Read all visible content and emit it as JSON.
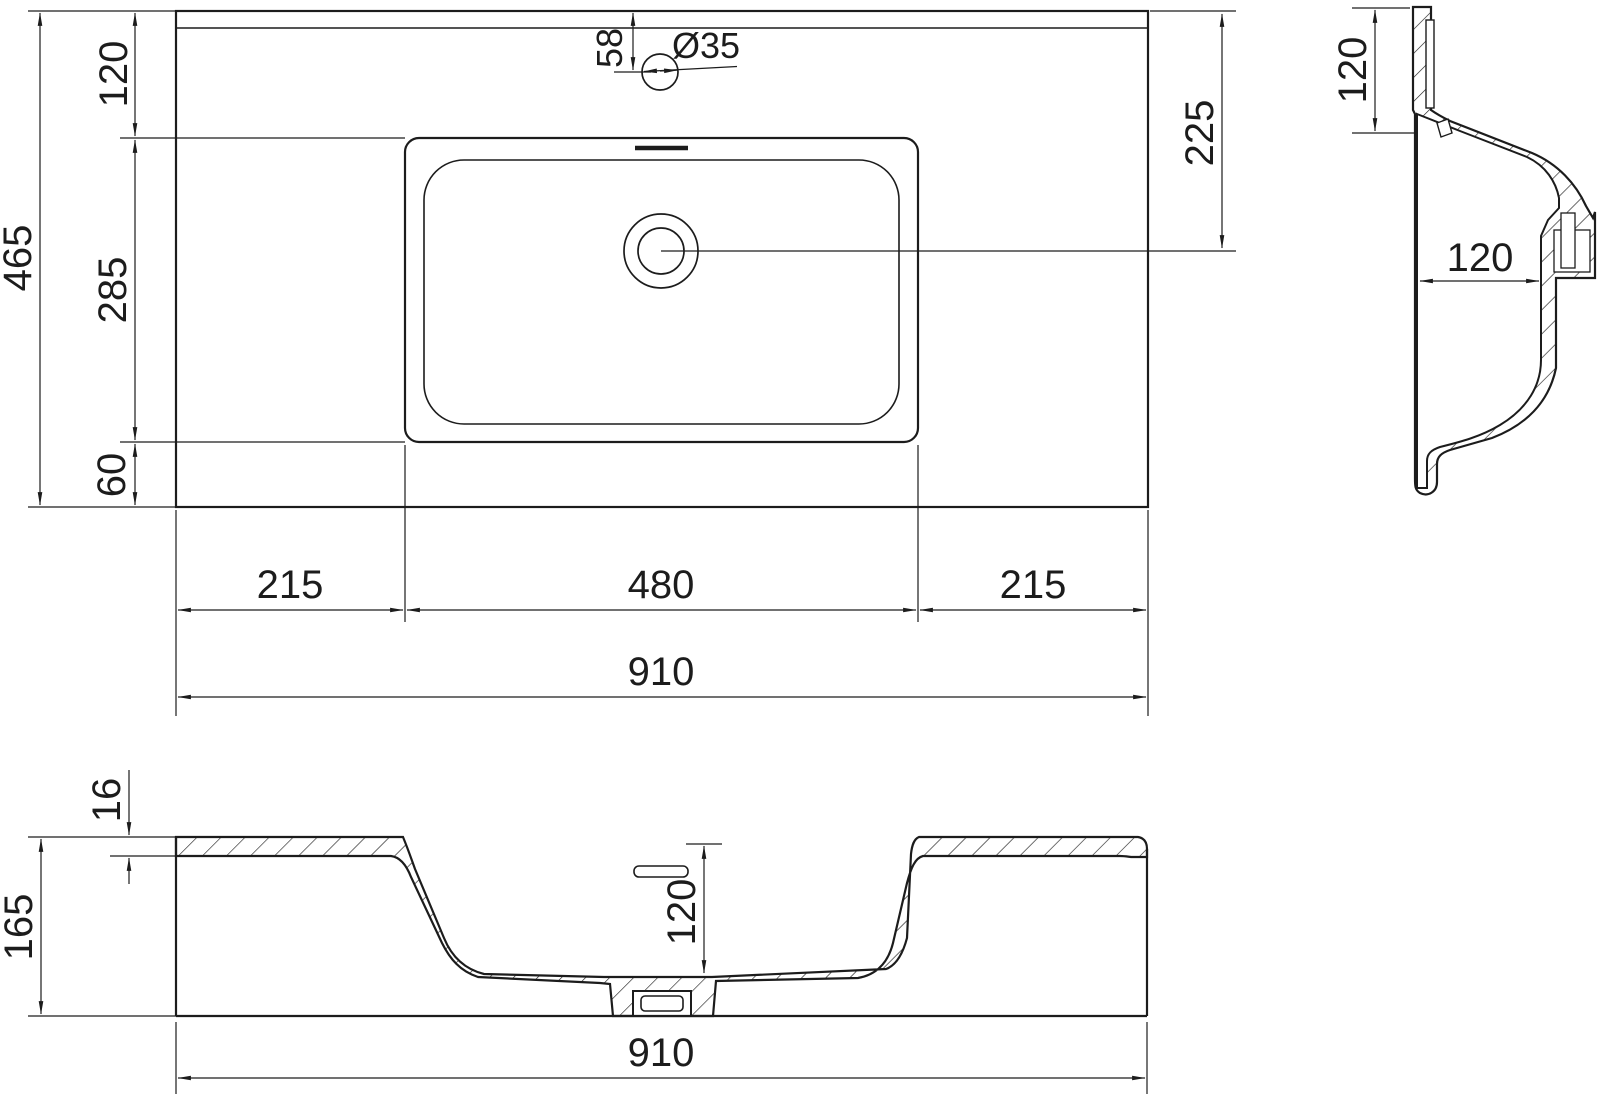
{
  "drawing": {
    "type": "technical-dimension-drawing",
    "subject": "rectangular vanity washbasin, three orthographic views",
    "colors": {
      "line": "#1c1c1c",
      "background": "#ffffff"
    },
    "views": {
      "top": {
        "overall_depth": "465",
        "back_ledge": "120",
        "basin_depth": "285",
        "front_ledge": "60",
        "faucet_offset": "58",
        "faucet_hole_diameter": "Ø35",
        "drain_center_from_back": "225",
        "left_ledge": "215",
        "basin_width": "480",
        "right_ledge": "215",
        "overall_width": "910"
      },
      "side": {
        "back_ledge_width": "120",
        "bowl_depth": "120"
      },
      "front": {
        "top_thickness": "16",
        "overall_height": "165",
        "bowl_depth": "120",
        "overall_width": "910"
      }
    }
  }
}
